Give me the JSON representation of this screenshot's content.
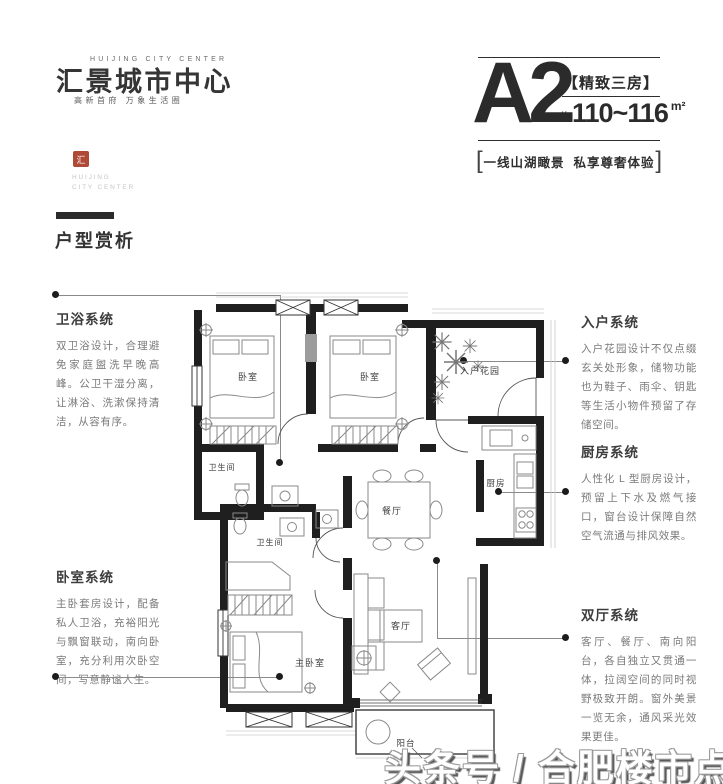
{
  "brand": {
    "logo_en": "HUIJING CITY CENTER",
    "logo_cn": "汇景城市中心",
    "logo_sub": "高新首府 万象生活圈",
    "seal_text": "汇",
    "seal_color": "#b04a36",
    "seal_caption_line1": "HUIJING",
    "seal_caption_line2": "CITY CENTER"
  },
  "unit": {
    "name": "A2",
    "tag": "【精致三房】",
    "approx": "约",
    "area": "110~116",
    "area_unit": "m²",
    "bracket_left": "[",
    "bracket_right": "]",
    "slogan": "一线山湖瞰景  私享尊奢体验"
  },
  "section": {
    "title": "户型赏析"
  },
  "annotations": {
    "left": [
      {
        "title": "卫浴系统",
        "body": "双卫浴设计，合理避免家庭盥洗早晚高峰。公卫干湿分离，让淋浴、洗漱保持清洁，从容有序。"
      },
      {
        "title": "卧室系统",
        "body": "主卧套房设计，配备私人卫浴，充裕阳光与飘窗联动，南向卧室，充分利用次卧空间，写意静谧人生。"
      }
    ],
    "right": [
      {
        "title": "入户系统",
        "body": "入户花园设计不仅点缀玄关处形象，储物功能也为鞋子、雨伞、钥匙等生活小物件预留了存储空间。"
      },
      {
        "title": "厨房系统",
        "body": "人性化 L 型厨房设计，预留上下水及燃气接口，窗台设计保障自然空气流通与排风效果。"
      },
      {
        "title": "双厅系统",
        "body": "客厅、餐厅、南向阳台，各自独立又贯通一体，拉阔空间的同时视野极致开朗。窗外美景一览无余，通风采光效果更佳。"
      }
    ]
  },
  "floorplan": {
    "wall_color": "#1f1f1f",
    "furniture_color": "#8a8a8a",
    "rooms": {
      "bedroom1": "卧室",
      "bedroom2": "卧室",
      "entry_garden": "入户花园",
      "bath1": "卫生间",
      "bath2": "卫生间",
      "dining": "餐厅",
      "kitchen": "厨房",
      "living": "客厅",
      "master": "主卧室",
      "balcony": "阳台"
    }
  },
  "watermark": {
    "text": "头条号 / 合肥楼市点评"
  }
}
